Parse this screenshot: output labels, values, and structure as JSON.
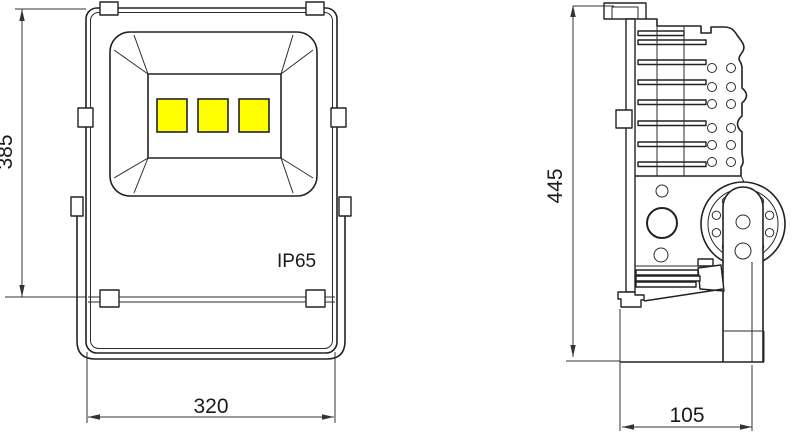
{
  "front_view": {
    "height_label": "385",
    "width_label": "320",
    "ip_rating": "IP65",
    "led_count": 3
  },
  "side_view": {
    "height_label": "445",
    "depth_label": "105"
  },
  "colors": {
    "line": "#222222",
    "led_fill": "#ffff00",
    "background": "#ffffff"
  }
}
